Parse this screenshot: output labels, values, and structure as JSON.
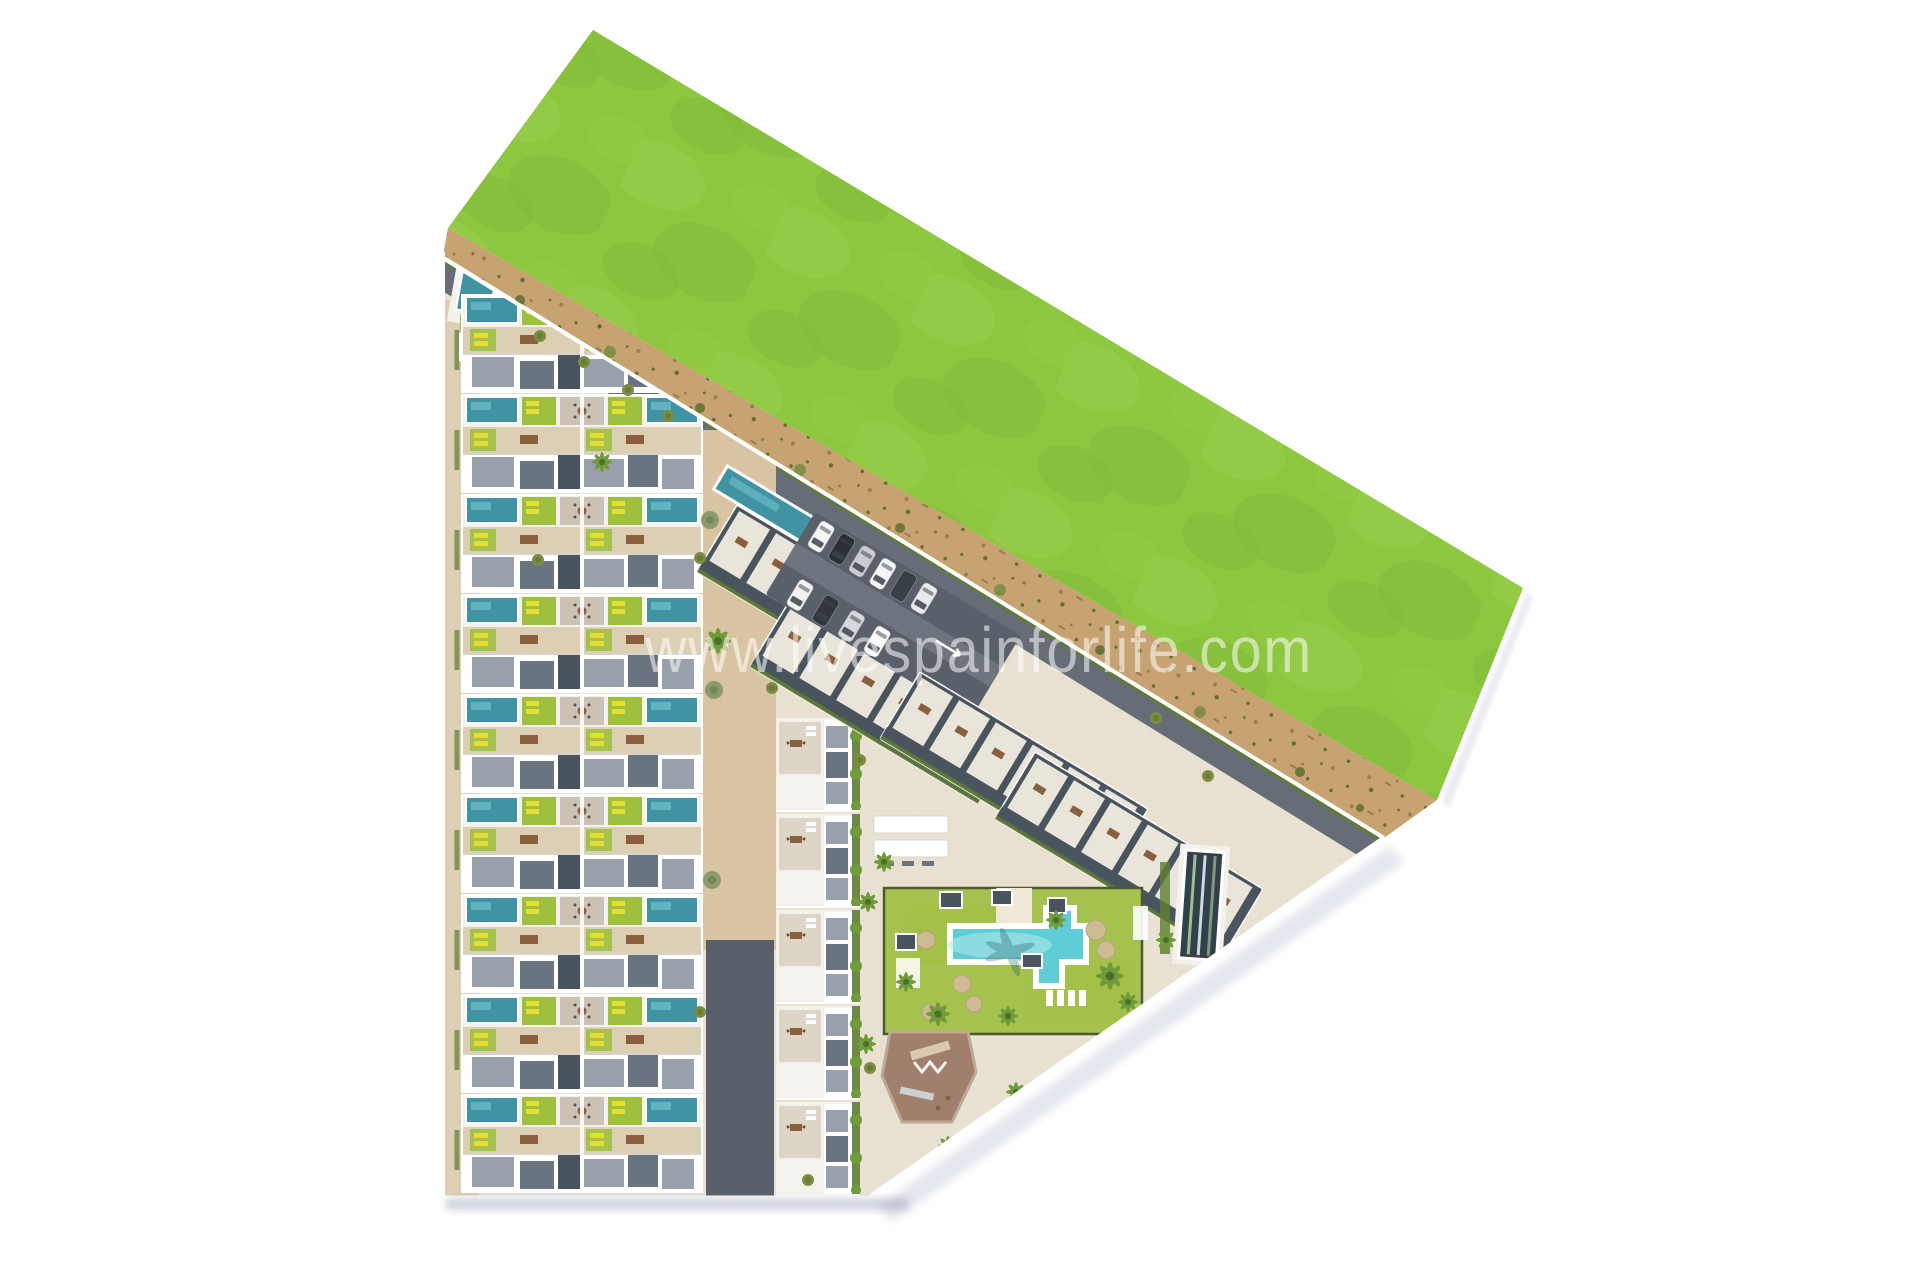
{
  "watermark": {
    "text": "www.livespainforlife.com"
  },
  "scene": {
    "type": "aerial-site-plan-render",
    "areas": [
      "grass-field",
      "beach-dune-strip",
      "townhouse-rows",
      "apartment-rows",
      "parking-lot",
      "amenity-garden",
      "swimming-pool",
      "lap-pool",
      "playground"
    ]
  },
  "colors": {
    "bg": "#ffffff",
    "grass": "#8dc63f",
    "grassLight": "#9cd14d",
    "grassDark": "#7cb636",
    "sand": "#c7a372",
    "sandDark": "#9b7c4c",
    "scrub": "#5f6e30",
    "pavement": "#e9e2d3",
    "tileTan": "#ddcfb4",
    "plazaTan": "#d9c5a3",
    "roadDark": "#666d77",
    "asphalt": "#596069",
    "aisle": "#6e757f",
    "white": "#ffffff",
    "offWhite": "#f4f2ec",
    "roofGray": "#97a0ab",
    "roofMid": "#6a7380",
    "roofDark": "#4a545f",
    "patioGray": "#c9c2b5",
    "patioBeige": "#ddd5c6",
    "barRoof": "#e9e5da",
    "poolTeal": "#3f93a3",
    "poolTealLight": "#74c0cb",
    "bigPool": "#5ecdd6",
    "bigPoolLight": "#b2e9ed",
    "lapPool": "#32404c",
    "laneGreen": "#9fbe8f",
    "lawn": "#a5c24f",
    "lawnBright": "#9fbf3e",
    "hedge": "#5f7d33",
    "palm": "#6f9b3a",
    "palmDark": "#4c6e28",
    "bush": "#7b8d43",
    "tree": "#8a9a6b",
    "lounger": "#e6dd35",
    "furniture": "#8a5f3d",
    "umbrella": "#cdbb92",
    "playBrown": "#a07f6d",
    "playLight": "#bfa896",
    "shadow": "#8d93ab",
    "cutShadow": "#c5c9da",
    "fence": "#4b5a2e",
    "watermark": "rgba(255,255,255,0.55)"
  }
}
